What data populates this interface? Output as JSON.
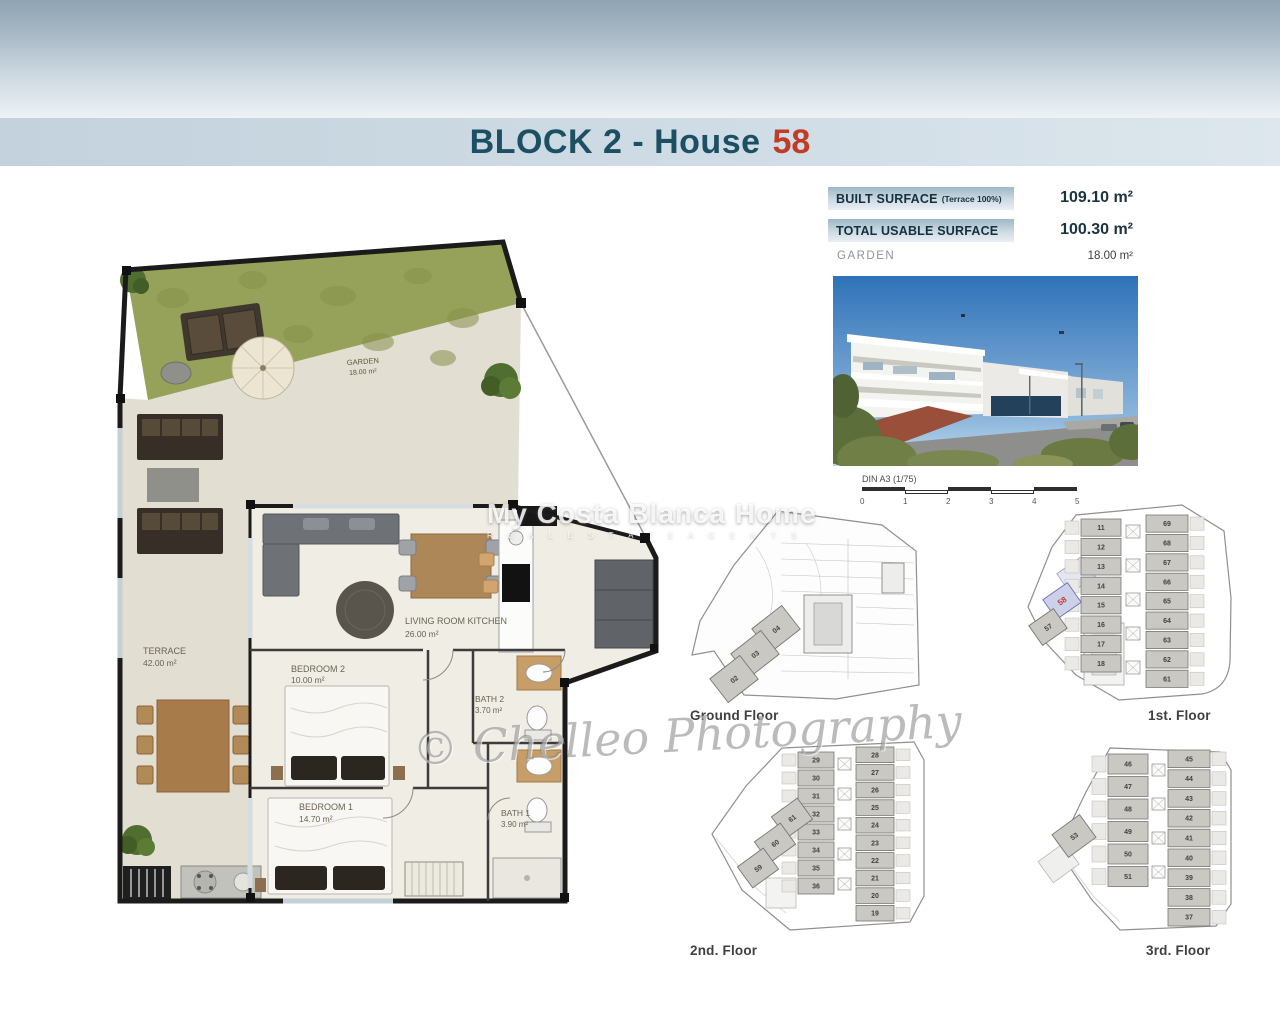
{
  "title": {
    "block": "BLOCK 2 - House",
    "house_number": "58"
  },
  "surfaces": {
    "built": {
      "label": "BUILT SURFACE",
      "note": "(Terrace 100%)",
      "value": "109.10 m²"
    },
    "usable": {
      "label": "TOTAL USABLE SURFACE",
      "value": "100.30 m²"
    },
    "garden": {
      "label": "GARDEN",
      "value": "18.00 m²"
    }
  },
  "scale": {
    "label": "DIN A3 (1/75)",
    "ticks": [
      "0",
      "1",
      "2",
      "3",
      "4",
      "5"
    ]
  },
  "floorplan": {
    "rooms": [
      {
        "name": "GARDEN",
        "area": "18.00 m²"
      },
      {
        "name": "TERRACE",
        "area": "42.00 m²"
      },
      {
        "name": "LIVING ROOM KITCHEN",
        "area": "26.00 m²"
      },
      {
        "name": "BEDROOM 2",
        "area": "10.00 m²"
      },
      {
        "name": "BATH 2",
        "area": "3.70 m²"
      },
      {
        "name": "BEDROOM 1",
        "area": "14.70 m²"
      },
      {
        "name": "BATH 1",
        "area": "3.90 m²"
      }
    ]
  },
  "mini_plans": [
    {
      "key": "ground",
      "label": "Ground Floor",
      "wing_units": [
        "04",
        "03",
        "02"
      ],
      "left_units": [],
      "right_units": []
    },
    {
      "key": "first",
      "label": "1st. Floor",
      "left_units": [
        "11",
        "12",
        "13",
        "14",
        "15",
        "16",
        "17",
        "18"
      ],
      "right_units": [
        "69",
        "68",
        "67",
        "66",
        "65",
        "64",
        "63",
        "62",
        "61"
      ],
      "wing_units": [
        "58",
        "57"
      ],
      "highlight_unit": "58"
    },
    {
      "key": "second",
      "label": "2nd. Floor",
      "left_units": [
        "29",
        "30",
        "31",
        "32",
        "33",
        "34",
        "35",
        "36"
      ],
      "right_units": [
        "28",
        "27",
        "26",
        "25",
        "24",
        "23",
        "22",
        "21",
        "20",
        "19"
      ],
      "wing_units": [
        "61",
        "60",
        "59"
      ]
    },
    {
      "key": "third",
      "label": "3rd. Floor",
      "left_units": [
        "46",
        "47",
        "48",
        "49",
        "50",
        "51"
      ],
      "right_units": [
        "45",
        "44",
        "43",
        "42",
        "41",
        "40",
        "39",
        "38",
        "37"
      ],
      "wing_units": [
        "53"
      ]
    }
  ],
  "watermarks": {
    "agency_line1": "My Costa Blanca Home",
    "agency_line2": "R E A L   E S T A T E   A G E N T S",
    "photography": "© Chelleo Photography"
  },
  "colors": {
    "title_blue": "#1d4f63",
    "accent_red": "#c23b26",
    "highlight_fill": "#ccd0e8",
    "garden_green": "#96a159",
    "terrace_beige": "#e3ded2",
    "interior": "#f0ede5"
  }
}
